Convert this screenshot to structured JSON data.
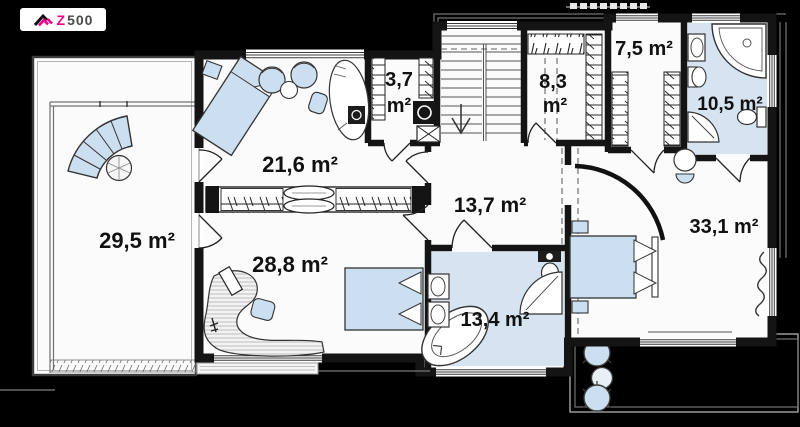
{
  "logo": {
    "brand_z": "Z",
    "brand_rest": "500"
  },
  "plan": {
    "rooms": [
      {
        "name": "terrace",
        "label": "29,5 m²"
      },
      {
        "name": "bedroom-upper",
        "label": "21,6 m²"
      },
      {
        "name": "closet",
        "value": "3,7",
        "unit": "m²"
      },
      {
        "name": "wardrobe-inner",
        "value": "8,3",
        "unit": "m²"
      },
      {
        "name": "wardrobe-master",
        "label": "7,5 m²"
      },
      {
        "name": "bathroom-ensuite",
        "label": "10,5 m²"
      },
      {
        "name": "hall",
        "label": "13,7 m²"
      },
      {
        "name": "bedroom-lower",
        "label": "28,8 m²"
      },
      {
        "name": "bathroom-main",
        "label": "13,4 m²"
      },
      {
        "name": "bedroom-master",
        "label": "33,1 m²"
      }
    ]
  },
  "colors": {
    "background": "#000000",
    "wall": "#141414",
    "floor": "#fbfbfb",
    "bath_floor": "#d6e4f2",
    "furniture_blue": "#ccdff0",
    "accent_pink": "#ec008c"
  }
}
